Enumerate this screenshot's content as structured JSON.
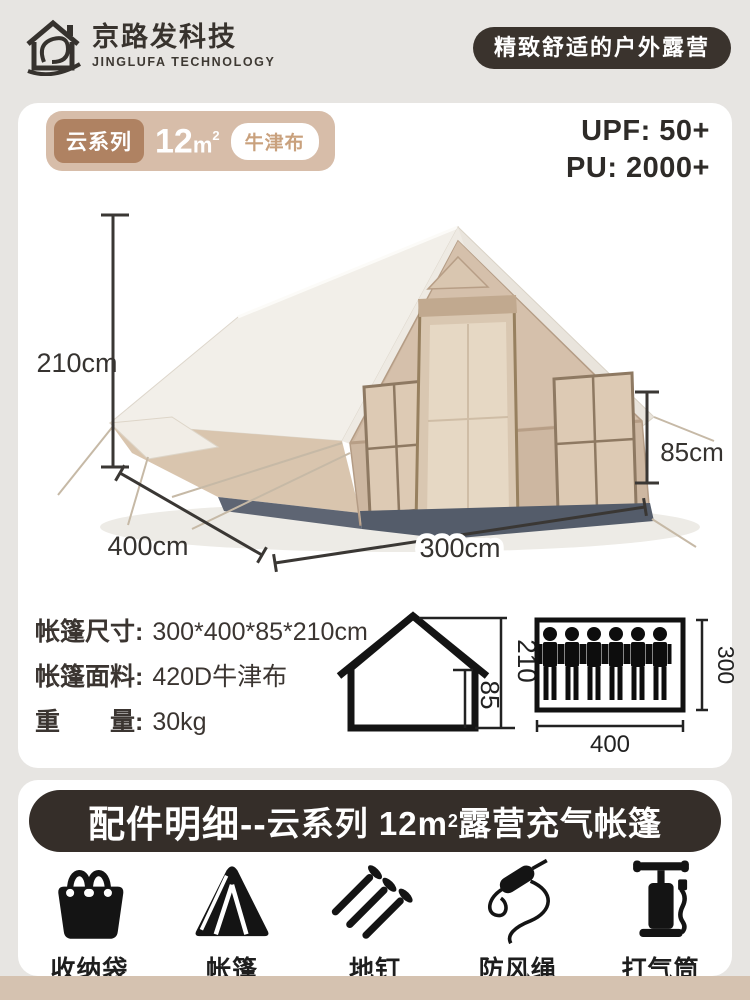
{
  "header": {
    "brand_cn": "京路发科技",
    "brand_en": "JINGLUFA TECHNOLOGY",
    "slogan": "精致舒适的户外露营"
  },
  "hero": {
    "series": "云系列",
    "area_num": "12",
    "area_unit": "m",
    "area_sup": "2",
    "fabric": "牛津布",
    "upf": "UPF: 50+",
    "pu": "PU: 2000+"
  },
  "tent_dims": {
    "height": "210cm",
    "side": "400cm",
    "front": "300cm",
    "wall": "85cm"
  },
  "specs": {
    "rows": [
      {
        "label": "帐篷尺寸:",
        "value": "300*400*85*210cm"
      },
      {
        "label": "帐篷面料:",
        "value": "420D牛津布"
      },
      {
        "label": "重　　量:",
        "value": "30kg"
      }
    ],
    "house": {
      "total": "210",
      "wall": "85"
    },
    "capacity": {
      "persons": 6,
      "width": "400",
      "depth": "300"
    }
  },
  "accessories": {
    "title_prefix": "配件明细--",
    "title_mid": "云系列 12m",
    "title_sup": "2",
    "title_suffix": "露营充气帐篷",
    "items": [
      {
        "name": "收纳袋",
        "icon": "storage-bag-icon"
      },
      {
        "name": "帐篷",
        "icon": "tent-icon"
      },
      {
        "name": "地钉",
        "icon": "ground-stake-icon"
      },
      {
        "name": "防风绳",
        "icon": "wind-rope-icon"
      },
      {
        "name": "打气筒",
        "icon": "air-pump-icon"
      }
    ]
  },
  "colors": {
    "page_bg": "#e7e5e2",
    "card_bg": "#ffffff",
    "dark_banner": "#352e29",
    "badge_outer": "#d7bda9",
    "badge_brown": "#af8262",
    "fabric_text": "#c9a17d",
    "bottom_strip": "#d5c2b0"
  }
}
